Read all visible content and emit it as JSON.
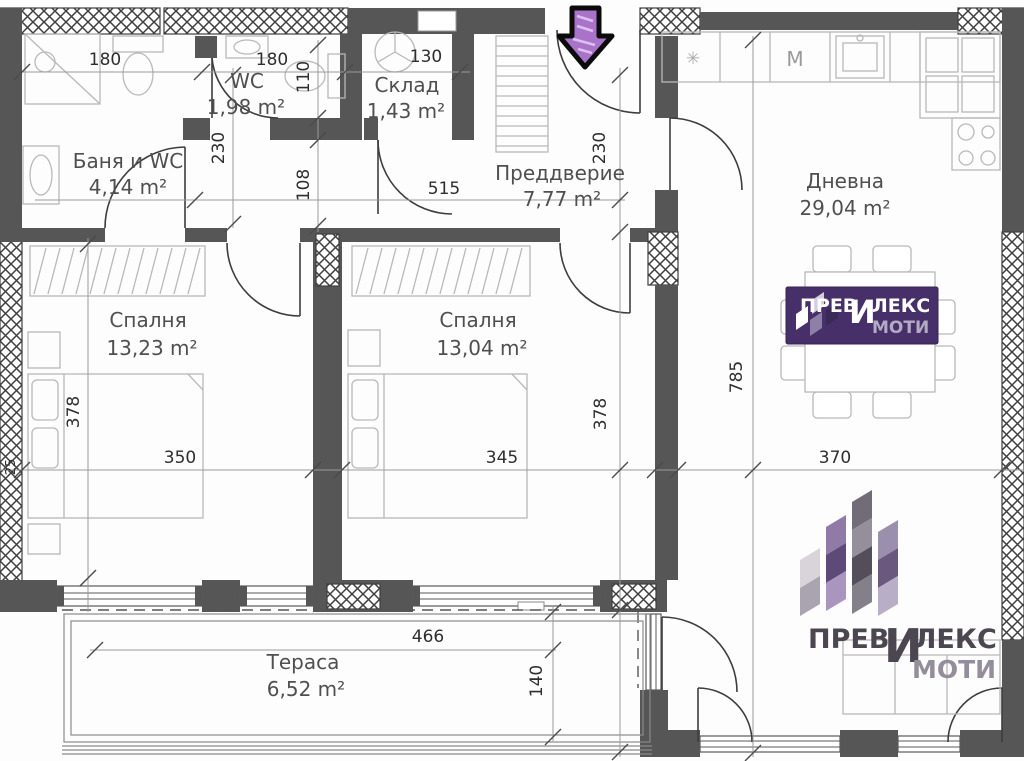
{
  "rooms": [
    {
      "name": "Баня и WC",
      "area": "4,14 m²"
    },
    {
      "name": "WC",
      "area": "1,98 m²"
    },
    {
      "name": "Склад",
      "area": "1,43 m²"
    },
    {
      "name": "Преддверие",
      "area": "7,77 m²"
    },
    {
      "name": "Дневна",
      "area": "29,04 m²"
    },
    {
      "name": "Спалня",
      "area": "13,23 m²"
    },
    {
      "name": "Спалня",
      "area": "13,04 m²"
    },
    {
      "name": "Тераса",
      "area": "6,52 m²"
    }
  ],
  "dims": {
    "bath_width": "180",
    "wc_width": "180",
    "wc_height": "110",
    "storage_width": "130",
    "bath_height": "230",
    "hall_width": "515",
    "hall_height": "230",
    "corridor_height": "108",
    "bedroom1_width": "350",
    "bedroom1_height": "378",
    "bedroom2_width": "345",
    "bedroom2_height": "378",
    "living_width": "370",
    "living_height": "785",
    "terrace_width": "466",
    "terrace_depth": "140",
    "wall_thickness": "25"
  },
  "labels": {
    "washer": "M",
    "fridge_symbol": "✳"
  },
  "brand": {
    "part1": "ПРЕВ",
    "big_letter": "И",
    "part2": "ЛЕКС",
    "part3": "МОТИ"
  },
  "colors": {
    "wall": "#565656",
    "logo_purple": "#473069",
    "logo_text_gray": "#9a93a8",
    "arrow_fill": "#a873c8"
  }
}
